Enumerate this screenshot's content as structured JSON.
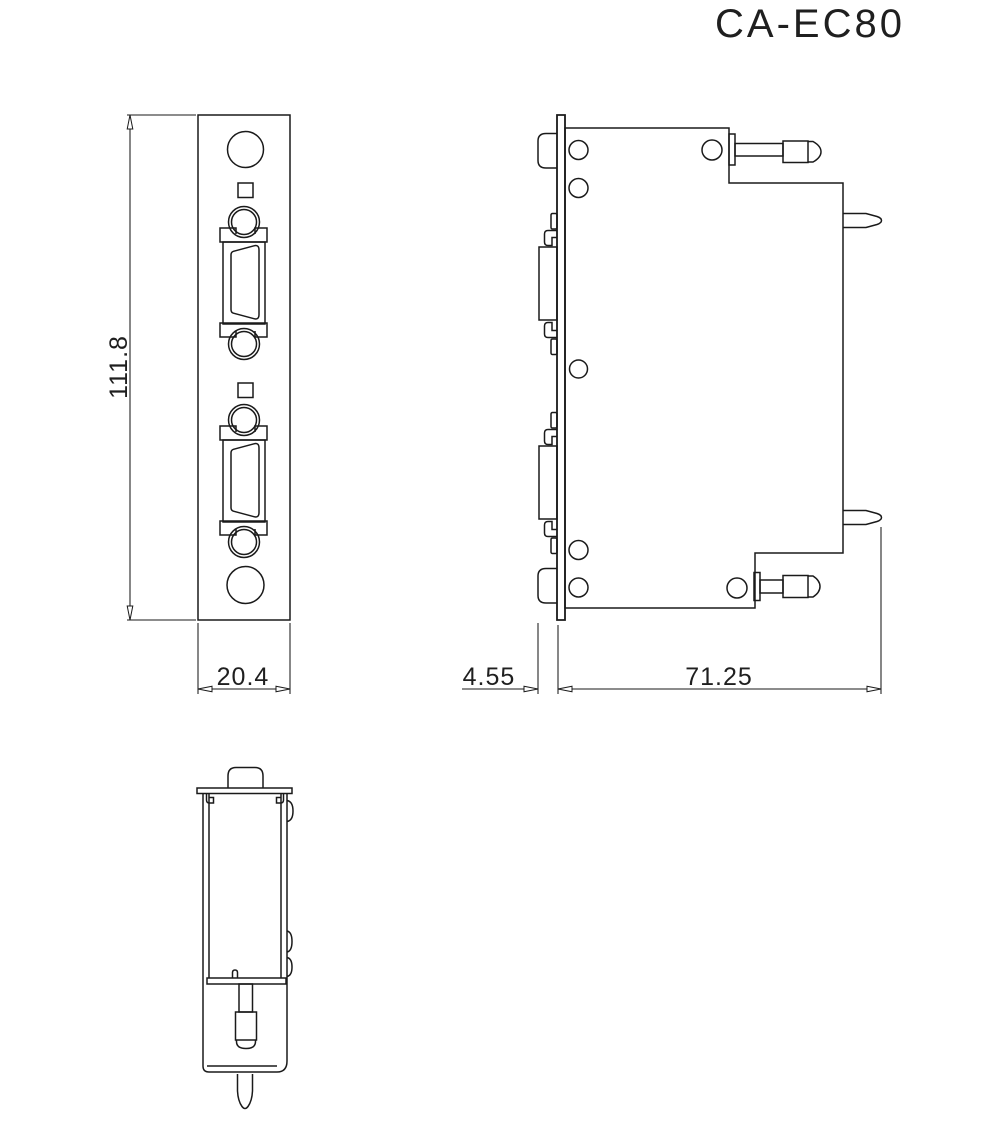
{
  "title": "CA-EC80",
  "drawing": {
    "type": "mechanical-orthographic-views",
    "views": [
      "front",
      "side",
      "bottom"
    ],
    "dimensions": {
      "overall_height": "111.8",
      "panel_width": "20.4",
      "connector_protrusion": "4.55",
      "body_depth": "71.25"
    },
    "colors": {
      "line": "#1a1a1a",
      "background": "#ffffff"
    }
  }
}
